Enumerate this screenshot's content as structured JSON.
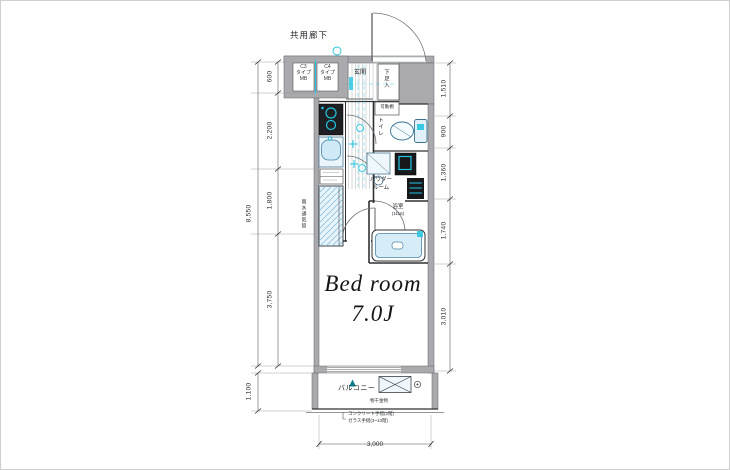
{
  "header": {
    "corridor_label": "共用廊下"
  },
  "plan": {
    "mb_left": [
      "C3",
      "タイプ",
      "MB"
    ],
    "mb_right": [
      "C4",
      "タイプ",
      "MB"
    ],
    "entrance": "玄関",
    "shoe_cabinet": "下足入",
    "movable_shelf": "可動棚",
    "toilet": "トイレ",
    "powder_room_line1": "パウダー",
    "powder_room_line2": "ルーム",
    "bathroom": "浴室",
    "bathroom_size": "(1116)",
    "bedroom_line1": "Bed room",
    "bedroom_line2": "7.0J",
    "balcony": "バルコニー",
    "laundry_hardware": "物干金物",
    "vent_pipe": "雨水通気管",
    "railing_note_line1": "コンクリート手摺(2階)",
    "railing_note_line2": "ガラス手摺(3~13階)"
  },
  "dimensions": {
    "left_total": "8,550",
    "left_segments": [
      "600",
      "2,200",
      "1,800",
      "3,750"
    ],
    "balcony_depth": "1,100",
    "right_segments": [
      "1,510",
      "900",
      "1,360",
      "1,740",
      "3,010"
    ],
    "bottom_width": "3,000"
  },
  "colors": {
    "accent_cyan": "#22c4e0",
    "wall_gray": "#a9a9ae",
    "fixture_blue": "#d6ecf7",
    "line": "#2f3133"
  }
}
